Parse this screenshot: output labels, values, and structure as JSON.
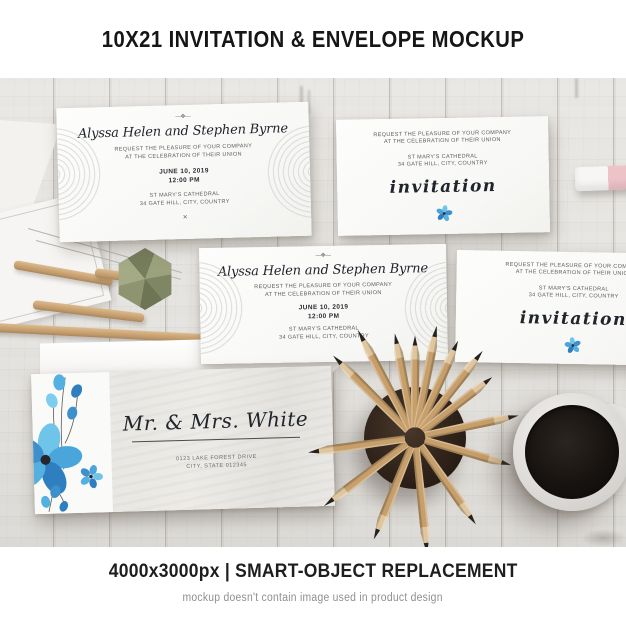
{
  "banner_top": {
    "title": "10X21 INVITATION & ENVELOPE MOCKUP"
  },
  "banner_bottom": {
    "specs": "4000x3000px | SMART-OBJECT REPLACEMENT",
    "disclaimer": "mockup doesn't contain image used in product design"
  },
  "names_card": {
    "ornament_top": "—❖—",
    "couple_names": "Alyssa Helen and Stephen Byrne",
    "request_line1": "REQUEST THE PLEASURE OF YOUR COMPANY",
    "request_line2": "AT THE CELEBRATION OF THEIR UNION",
    "date": "JUNE 10, 2019",
    "time": "12:00 PM",
    "venue": "ST MARY'S CATHEDRAL",
    "venue_address": "34 GATE HILL, CITY, COUNTRY",
    "ornament_bottom": "✕"
  },
  "invitation_card": {
    "request_line1": "REQUEST THE PLEASURE OF YOUR COMPANY",
    "request_line2": "AT THE CELEBRATION OF THEIR UNION",
    "venue": "ST MARY'S CATHEDRAL",
    "venue_address": "34 GATE HILL, CITY, COUNTRY",
    "script_word": "invitation"
  },
  "envelope": {
    "recipient": "Mr. & Mrs. White",
    "address_line1": "0123 LAKE FOREST DRIVE",
    "address_line2": "CITY, STATE 012345"
  },
  "colors": {
    "flower_blue": "#49a5da",
    "flower_blue_light": "#6fc4ea",
    "flower_blue_dark": "#2f7fc0",
    "eraser_pink": "#eec3c8",
    "pencil_wood": "#c79f6b",
    "cup_brown": "#2b211a",
    "coffee_black": "#171310",
    "polyhedron_olive": "#87906c"
  }
}
